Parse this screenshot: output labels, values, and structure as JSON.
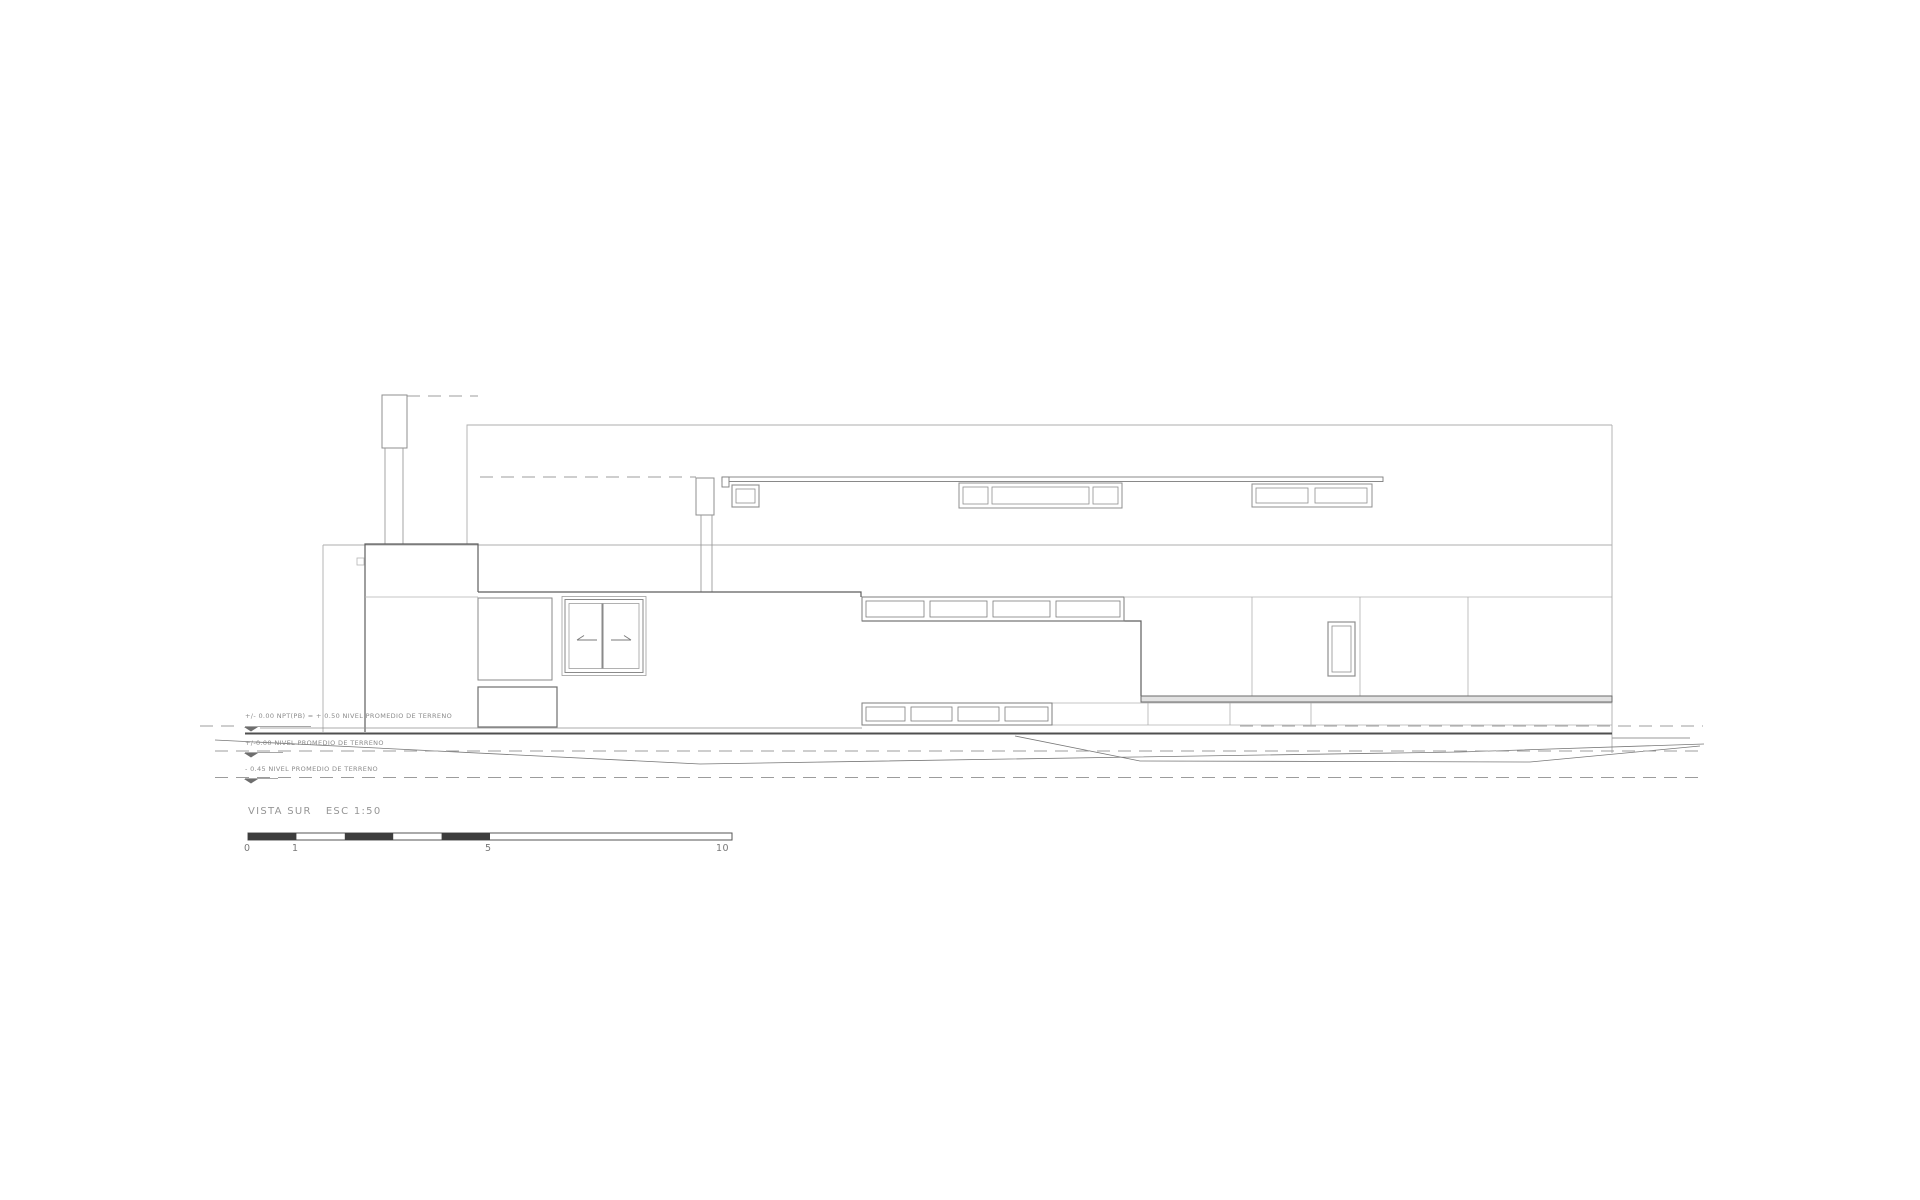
{
  "page": {
    "background": "#ffffff"
  },
  "drawing": {
    "title": {
      "view": "VISTA SUR",
      "scale": "ESC 1:50"
    },
    "levels": [
      {
        "label": "+/- 0.00 NPT(PB) = + 0.50  NIVEL PROMEDIO DE TERRENO"
      },
      {
        "label": "+/-0.00  NIVEL PROMEDIO DE TERRENO"
      },
      {
        "label": "- 0.45  NIVEL PROMEDIO DE TERRENO"
      }
    ],
    "scale_bar": {
      "ticks": [
        "0",
        "1",
        "5",
        "10"
      ]
    },
    "colors": {
      "line_light": "#adadad",
      "line_medium": "#8f8f8f",
      "line_dark": "#5e5e5e",
      "ground_heavy": "#4f4f4f",
      "terrain": "#787878",
      "dashed": "#9c9c9c",
      "bar_fill": "#3d3d3d",
      "text": "#8a8a8a"
    }
  }
}
